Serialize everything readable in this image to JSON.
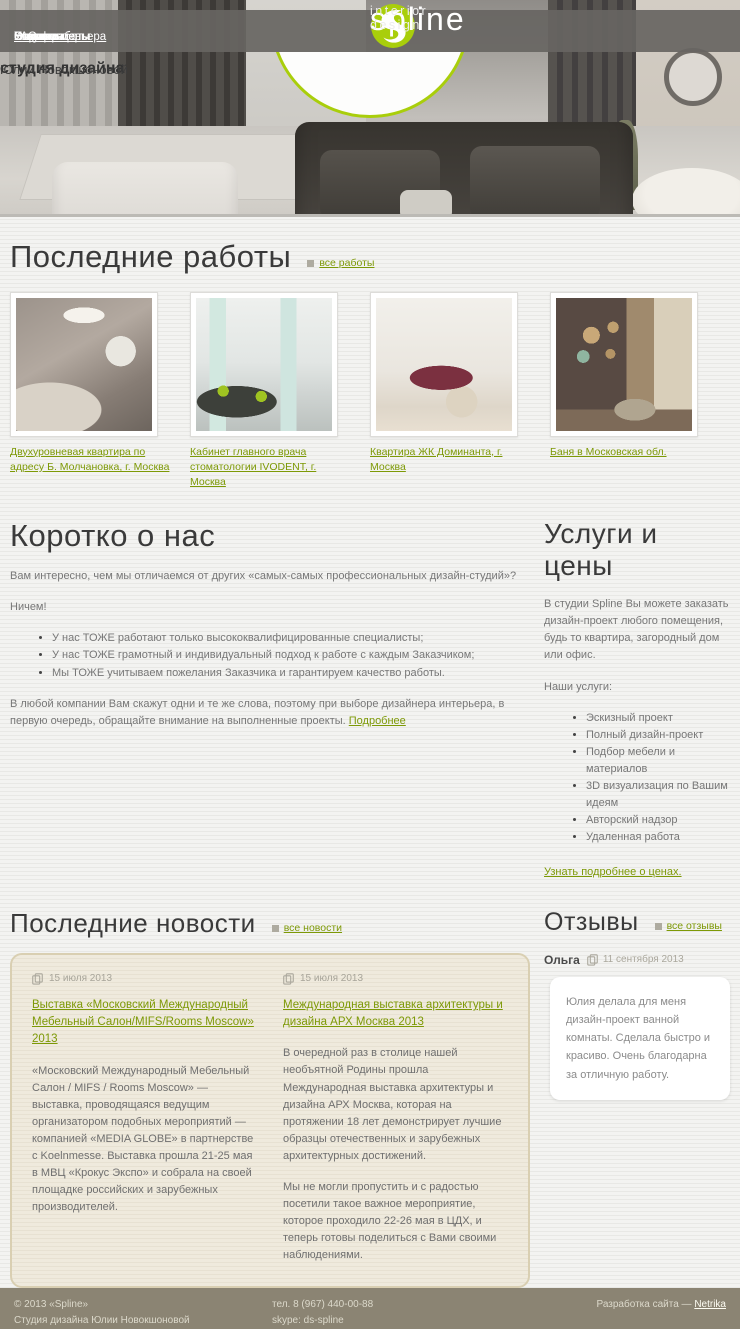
{
  "colors": {
    "accent_green": "#7d9906",
    "logo_green": "#a9ce0b",
    "footer_bg": "#8b8473"
  },
  "nav": {
    "left": [
      {
        "label": "О нас"
      },
      {
        "label": "Услуги и цены"
      },
      {
        "label": "FAQ"
      },
      {
        "label": "Этапы работы"
      },
      {
        "label": "Портфолио"
      }
    ],
    "right": [
      {
        "label": "Стили интерьера"
      },
      {
        "label": "Новости"
      },
      {
        "label": "Статьи"
      },
      {
        "label": "Отзывы"
      },
      {
        "label": "Контакты"
      }
    ]
  },
  "logo": {
    "name": "spline",
    "tagline": "interior design"
  },
  "badge": {
    "line1": "студия дизайна",
    "line2": "Юлии Новокшоновой"
  },
  "works": {
    "title": "Последние работы",
    "all_link": "все работы",
    "items": [
      {
        "caption": "Двухуровневая квартира по адресу Б. Молчановка, г. Москва"
      },
      {
        "caption": "Кабинет главного врача стоматологии IVODENT, г. Москва"
      },
      {
        "caption": "Квартира ЖК Доминанта, г. Москва"
      },
      {
        "caption": "Баня в Московская обл."
      }
    ]
  },
  "about": {
    "title": "Коротко о нас",
    "intro": "Вам интересно, чем мы отличаемся от других «самых-самых профессиональных дизайн-студий»?",
    "nothing": "Ничем!",
    "bullets": [
      "У нас ТОЖЕ работают только высококвалифицированные специалисты;",
      "У нас ТОЖЕ грамотный и индивидуальный подход к работе с каждым Заказчиком;",
      "Мы ТОЖЕ учитываем пожелания Заказчика и гарантируем качество работы."
    ],
    "outro": "В любой компании Вам скажут одни и те же слова, поэтому при выборе дизайнера интерьера, в первую очередь, обращайте внимание на выполненные проекты. ",
    "more_link": "Подробнее"
  },
  "services": {
    "title": "Услуги и цены",
    "intro": "В студии Spline Вы можете заказать дизайн-проект любого помещения, будь то квартира, загородный дом или офис.",
    "list_label": "Наши услуги:",
    "items": [
      "Эскизный проект",
      "Полный дизайн-проект",
      "Подбор мебели и материалов",
      "3D визуализация по Вашим идеям",
      "Авторский надзор",
      "Удаленная работа"
    ],
    "prices_link": "Узнать подробнее о ценах."
  },
  "news": {
    "title": "Последние новости",
    "all_link": "все новости",
    "items": [
      {
        "date": "15 июля 2013",
        "title": "Выставка «Московский Международный Мебельный Салон/MIFS/Rooms Moscow» 2013",
        "paragraphs": [
          "«Московский Международный Мебельный Салон / MIFS / Rooms Moscow» — выставка, проводящаяся ведущим организатором подобных мероприятий — компанией «MEDIA GLOBE» в партнерстве с Koelnmesse. Выставка прошла 21-25 мая в МВЦ «Крокус Экспо» и собрала на своей площадке российских и зарубежных производителей."
        ]
      },
      {
        "date": "15 июля 2013",
        "title": "Международная выставка архитектуры и дизайна АРХ Москва 2013",
        "paragraphs": [
          "В очередной раз в столице нашей необъятной Родины прошла Международная выставка архитектуры и дизайна АРХ Москва, которая на протяжении 18 лет демонстрирует лучшие образцы отечественных и зарубежных архитектурных достижений.",
          "Мы не могли пропустить и с радостью посетили такое важное мероприятие, которое проходило 22-26 мая в ЦДХ, и теперь готовы поделиться с Вами своими наблюдениями."
        ]
      }
    ]
  },
  "reviews": {
    "title": "Отзывы",
    "all_link": "все отзывы",
    "items": [
      {
        "author": "Ольга",
        "date": "11 сентября 2013",
        "text": "Юлия делала для меня дизайн-проект ванной комнаты. Сделала быстро и красиво. Очень благодарна за отличную работу."
      }
    ]
  },
  "footer": {
    "copyright": "© 2013 «Spline»",
    "studio": "Студия дизайна Юлии Новокшоновой",
    "phone": "тел. 8 (967) 440-00-88",
    "skype": "skype: ds-spline",
    "dev_label": "Разработка сайта — ",
    "dev_link": "Netrika"
  }
}
